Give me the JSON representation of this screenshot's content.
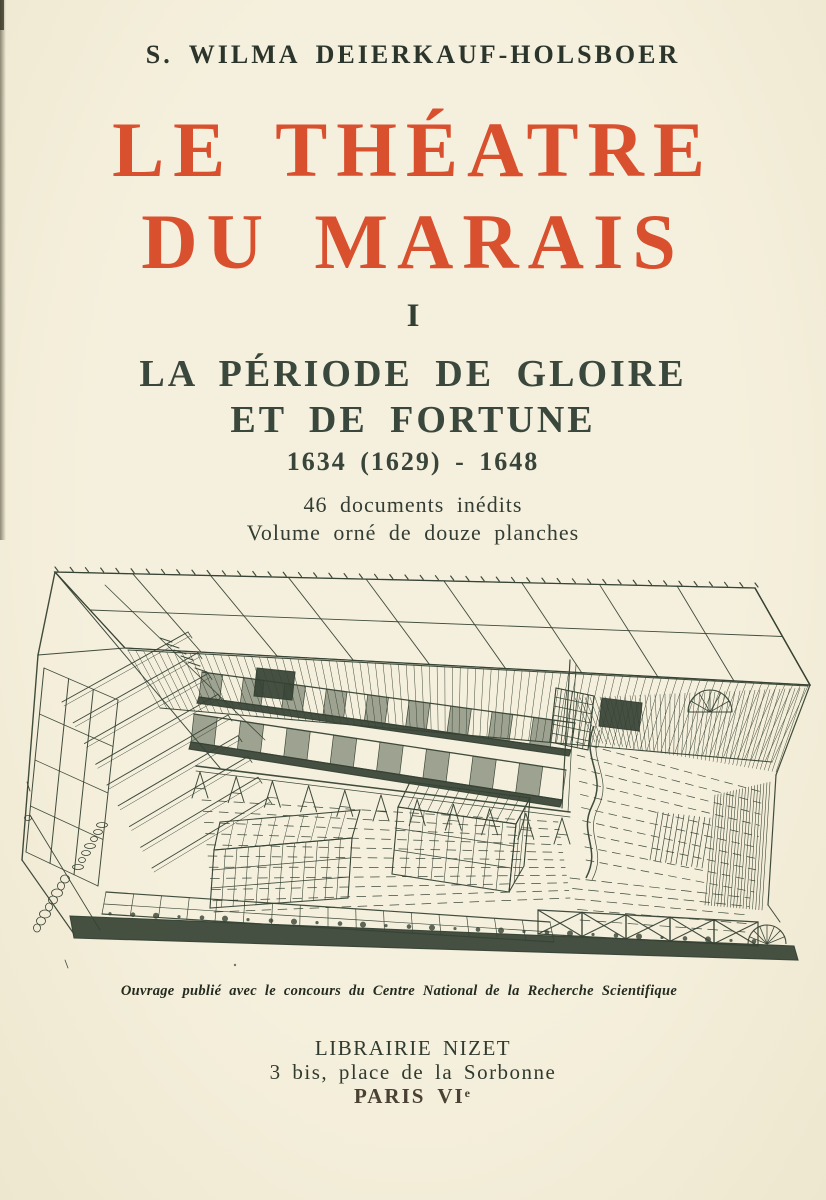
{
  "page": {
    "author": "S. WILMA DEIERKAUF-HOLSBOER",
    "title_line1": "LE THÉATRE",
    "title_line2": "DU MARAIS",
    "volume_numeral": "I",
    "subtitle_line1": "LA PÉRIODE DE GLOIRE",
    "subtitle_line2": "ET DE FORTUNE",
    "dates": "1634 (1629) - 1648",
    "note_line1": "46 documents inédits",
    "note_line2": "Volume orné de douze planches",
    "engraving": {
      "alt": "Cutaway aerial perspective engraving of the Théâtre du Marais playhouse: glazed roof grid, tiered benches at left, two side galleries, trestle-borne stage, spiral stair at lower right"
    },
    "engraving_caption": "Ouvrage publié avec le concours du Centre National de la Recherche Scientifique",
    "publisher": {
      "name": "LIBRAIRIE NIZET",
      "address": "3 bis, place de la Sorbonne",
      "city": "PARIS VI",
      "city_sup": "e"
    },
    "colors": {
      "paper": "#f3eed9",
      "title_red": "#d9502f",
      "text_ink": "#323c31",
      "city_ink": "#4a4033",
      "engraving_ink": "#364234"
    }
  }
}
